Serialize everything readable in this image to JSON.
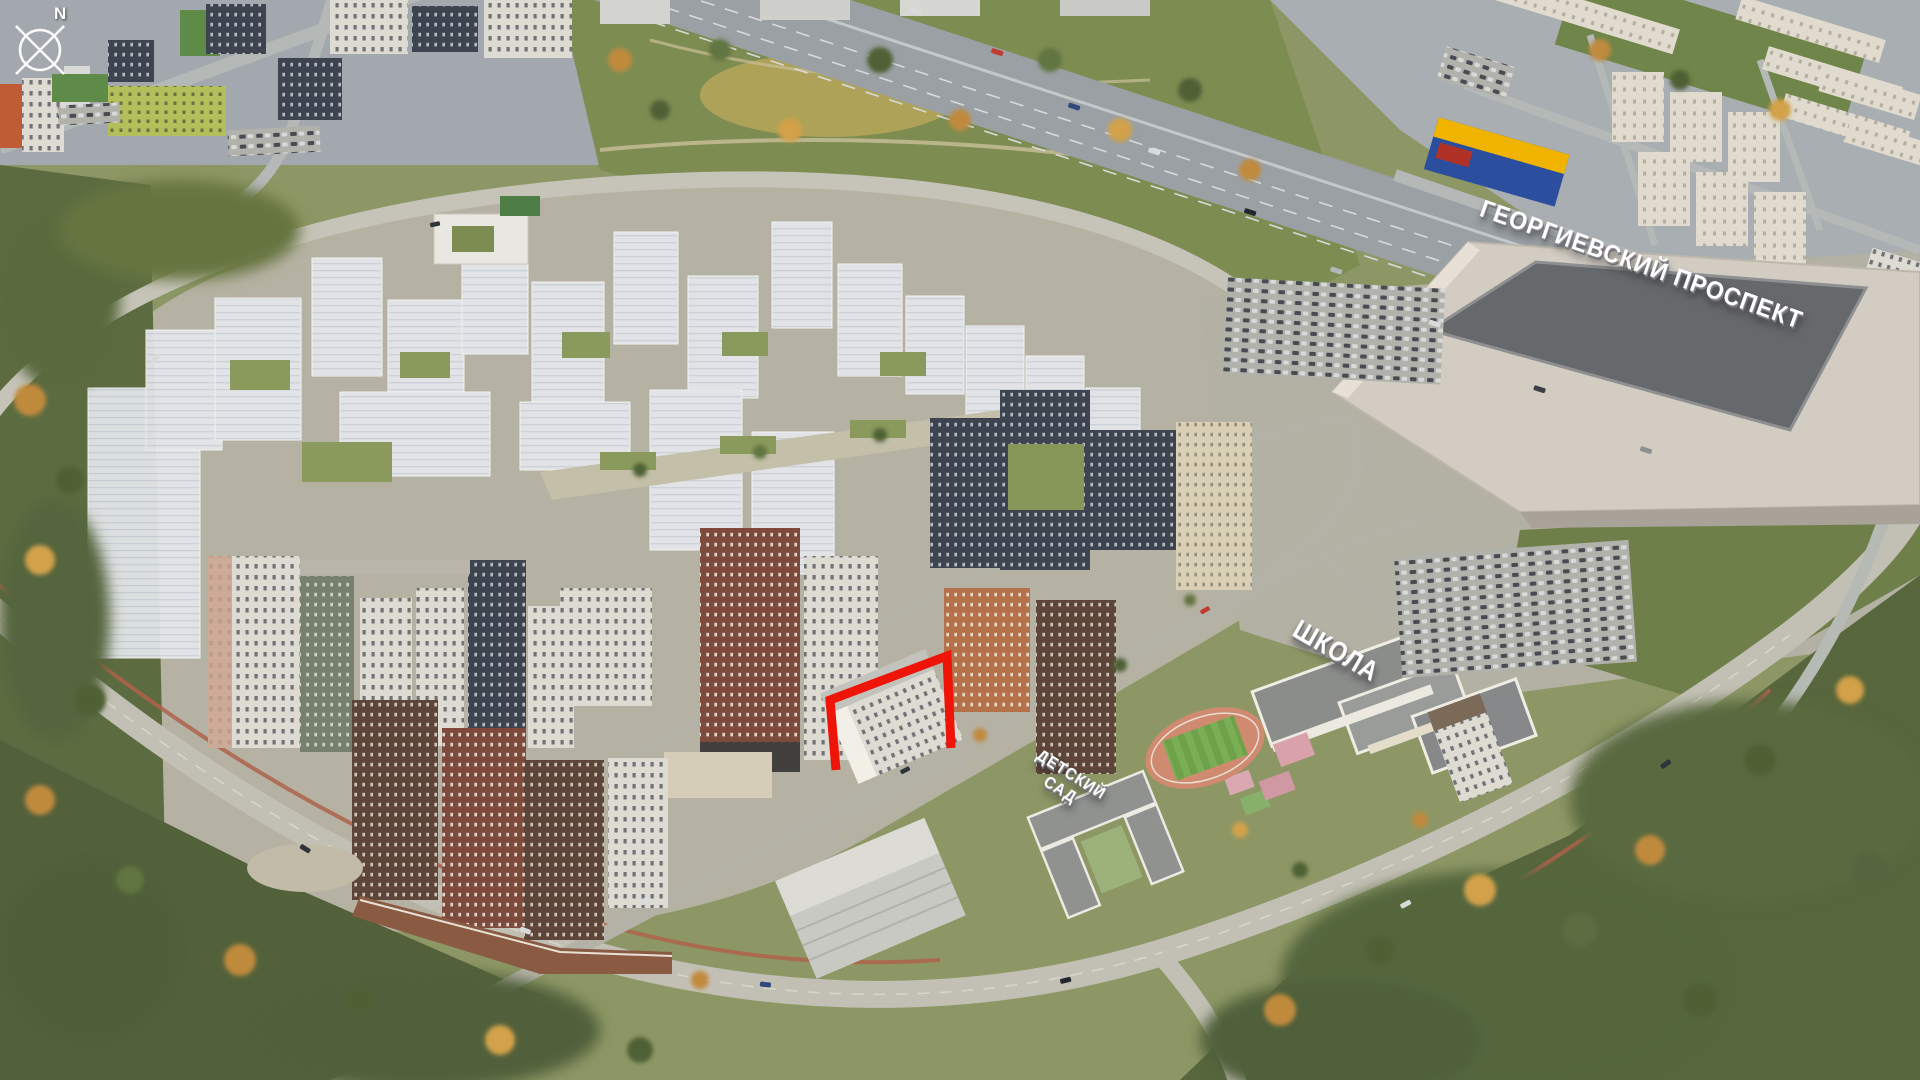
{
  "scene": {
    "kind": "aerial-masterplan-render",
    "description": "Aerial 3D render of a residential development surrounded by autumn forest and existing city"
  },
  "compass": {
    "label": "N"
  },
  "labels": {
    "avenue": "ГЕОРГИЕВСКИЙ ПРОСПЕКТ",
    "school": "ШКОЛА",
    "kindergarten": "ДЕТСКИЙ САД",
    "kindergarten_line1": "ДЕТСКИЙ",
    "kindergarten_line2": "САД"
  },
  "highlight": {
    "color": "#ee1408",
    "target": "selected-building-outline"
  }
}
